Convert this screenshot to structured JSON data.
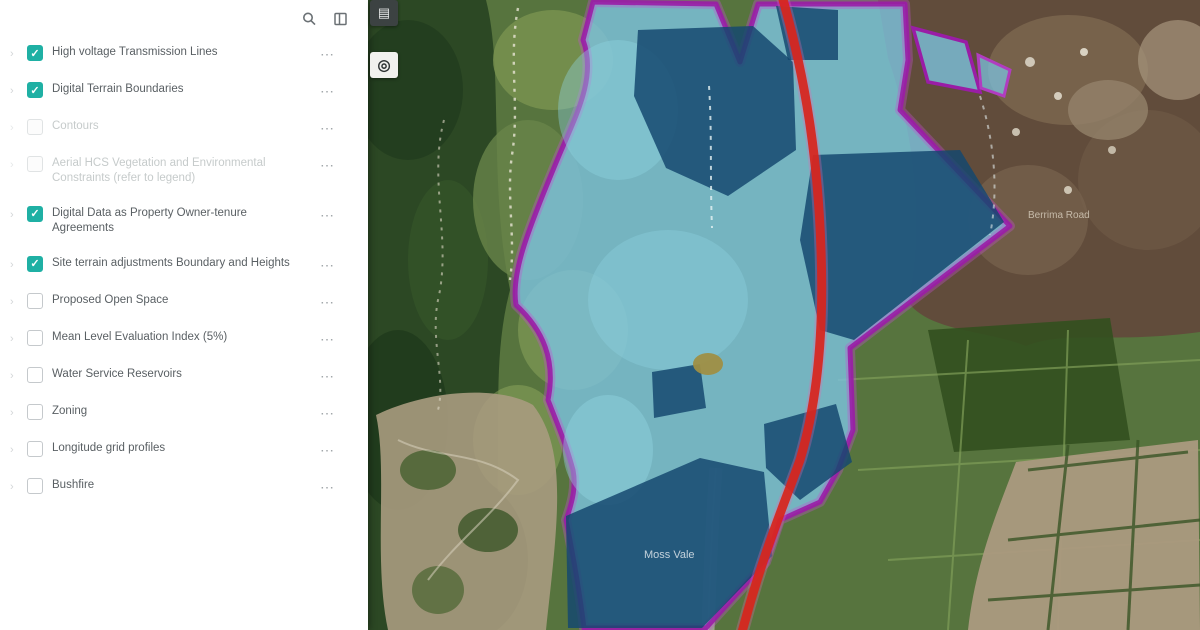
{
  "sidebar": {
    "tools": [
      {
        "name": "search",
        "label": "Search layers"
      },
      {
        "name": "expand-panel",
        "label": "Expand panel"
      }
    ],
    "row_menu_glyph": "⋯",
    "accent_color": "#1fb0a4",
    "layers": [
      {
        "label": "High voltage Transmission Lines",
        "checked": true,
        "disabled": false
      },
      {
        "label": "Digital Terrain Boundaries",
        "checked": true,
        "disabled": false
      },
      {
        "label": "Contours",
        "checked": false,
        "disabled": true
      },
      {
        "label": "Aerial HCS Vegetation and Environmental Constraints (refer to legend)",
        "checked": false,
        "disabled": true
      },
      {
        "label": "Digital Data as Property Owner-tenure Agreements",
        "checked": true,
        "disabled": false
      },
      {
        "label": "Site terrain adjustments Boundary and Heights",
        "checked": true,
        "disabled": false
      },
      {
        "label": "Proposed Open Space",
        "checked": false,
        "disabled": false
      },
      {
        "label": "Mean Level Evaluation Index (5%)",
        "checked": false,
        "disabled": false
      },
      {
        "label": "Water Service Reservoirs",
        "checked": false,
        "disabled": false
      },
      {
        "label": "Zoning",
        "checked": false,
        "disabled": false
      },
      {
        "label": "Longitude grid profiles",
        "checked": false,
        "disabled": false
      },
      {
        "label": "Bushfire",
        "checked": false,
        "disabled": false
      }
    ]
  },
  "map": {
    "controls": [
      {
        "name": "basemap-toggle",
        "glyph": "▤"
      },
      {
        "name": "locate",
        "glyph": "◎"
      }
    ],
    "labels": [
      {
        "text": "Moss Vale"
      },
      {
        "text": "Berrima Road"
      }
    ],
    "overlay_colors": {
      "precinct_fill": "#7cc2dd",
      "environmental_fill": "#14476f",
      "study_boundary": "#9a1da6",
      "main_road": "#d8251c"
    }
  }
}
